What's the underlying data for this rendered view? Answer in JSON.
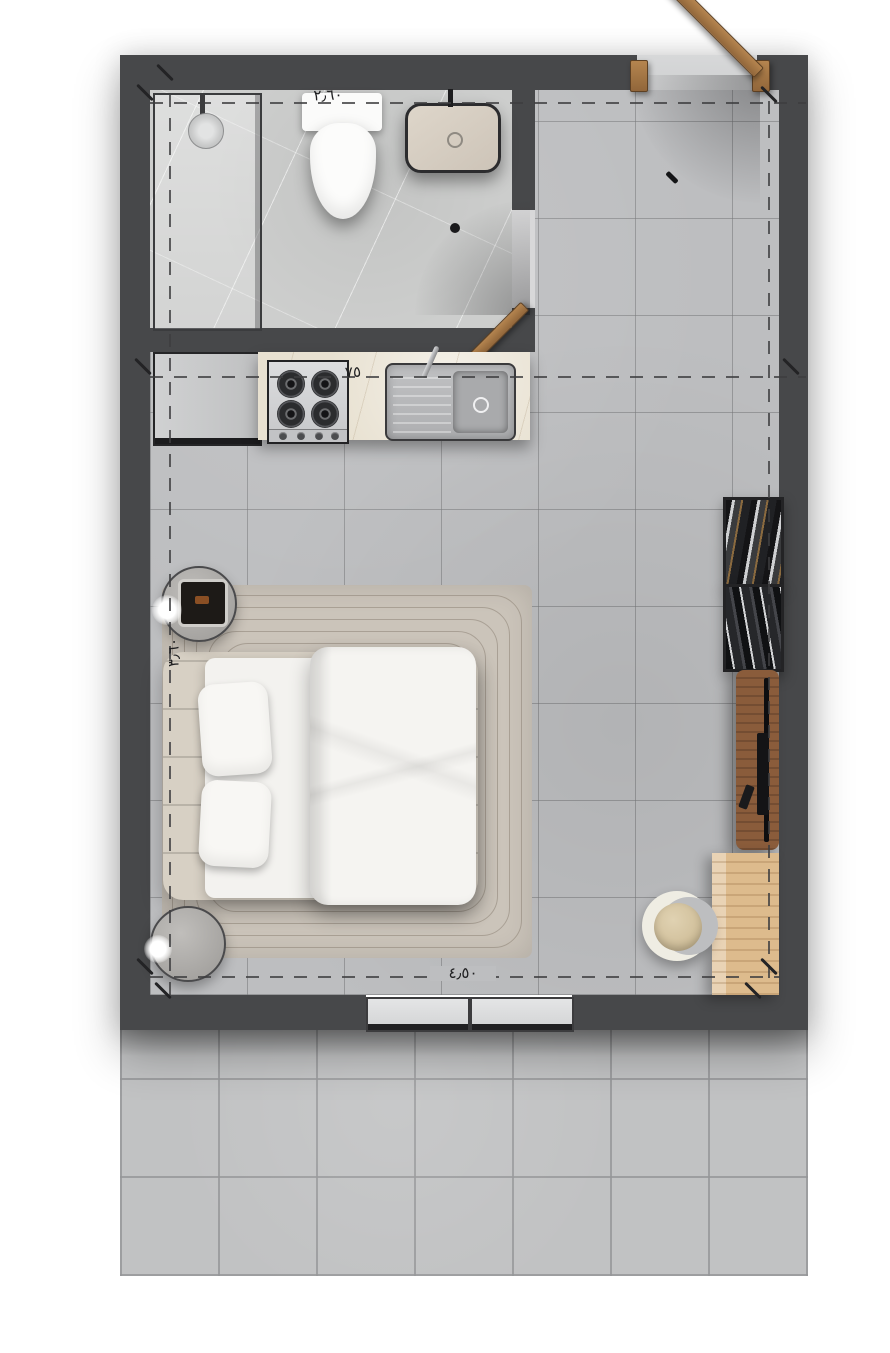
{
  "drawing": {
    "type": "apartment-floor-plan",
    "annotations": {
      "bathroom_width_label": "٢٫٦٠",
      "kitchen_counter_label": "٧٥",
      "room_height_label": "٣٫٦٠",
      "room_width_label": "٤٫٥٠"
    },
    "colors": {
      "wall": "#47484a",
      "floor_tile": "#bdbec0",
      "bathroom_floor": "#cdcecd",
      "terrace_tile": "#c1c2c3",
      "counter_marble": "#e8e1d1",
      "door_wood": "#a87848",
      "console_wood": "#8a5c3b",
      "desk_wood": "#ddbb8d",
      "rug": "#cbc4ba",
      "bedding_white": "#f3f2ef",
      "annotation_ink": "#1f1f21"
    }
  }
}
